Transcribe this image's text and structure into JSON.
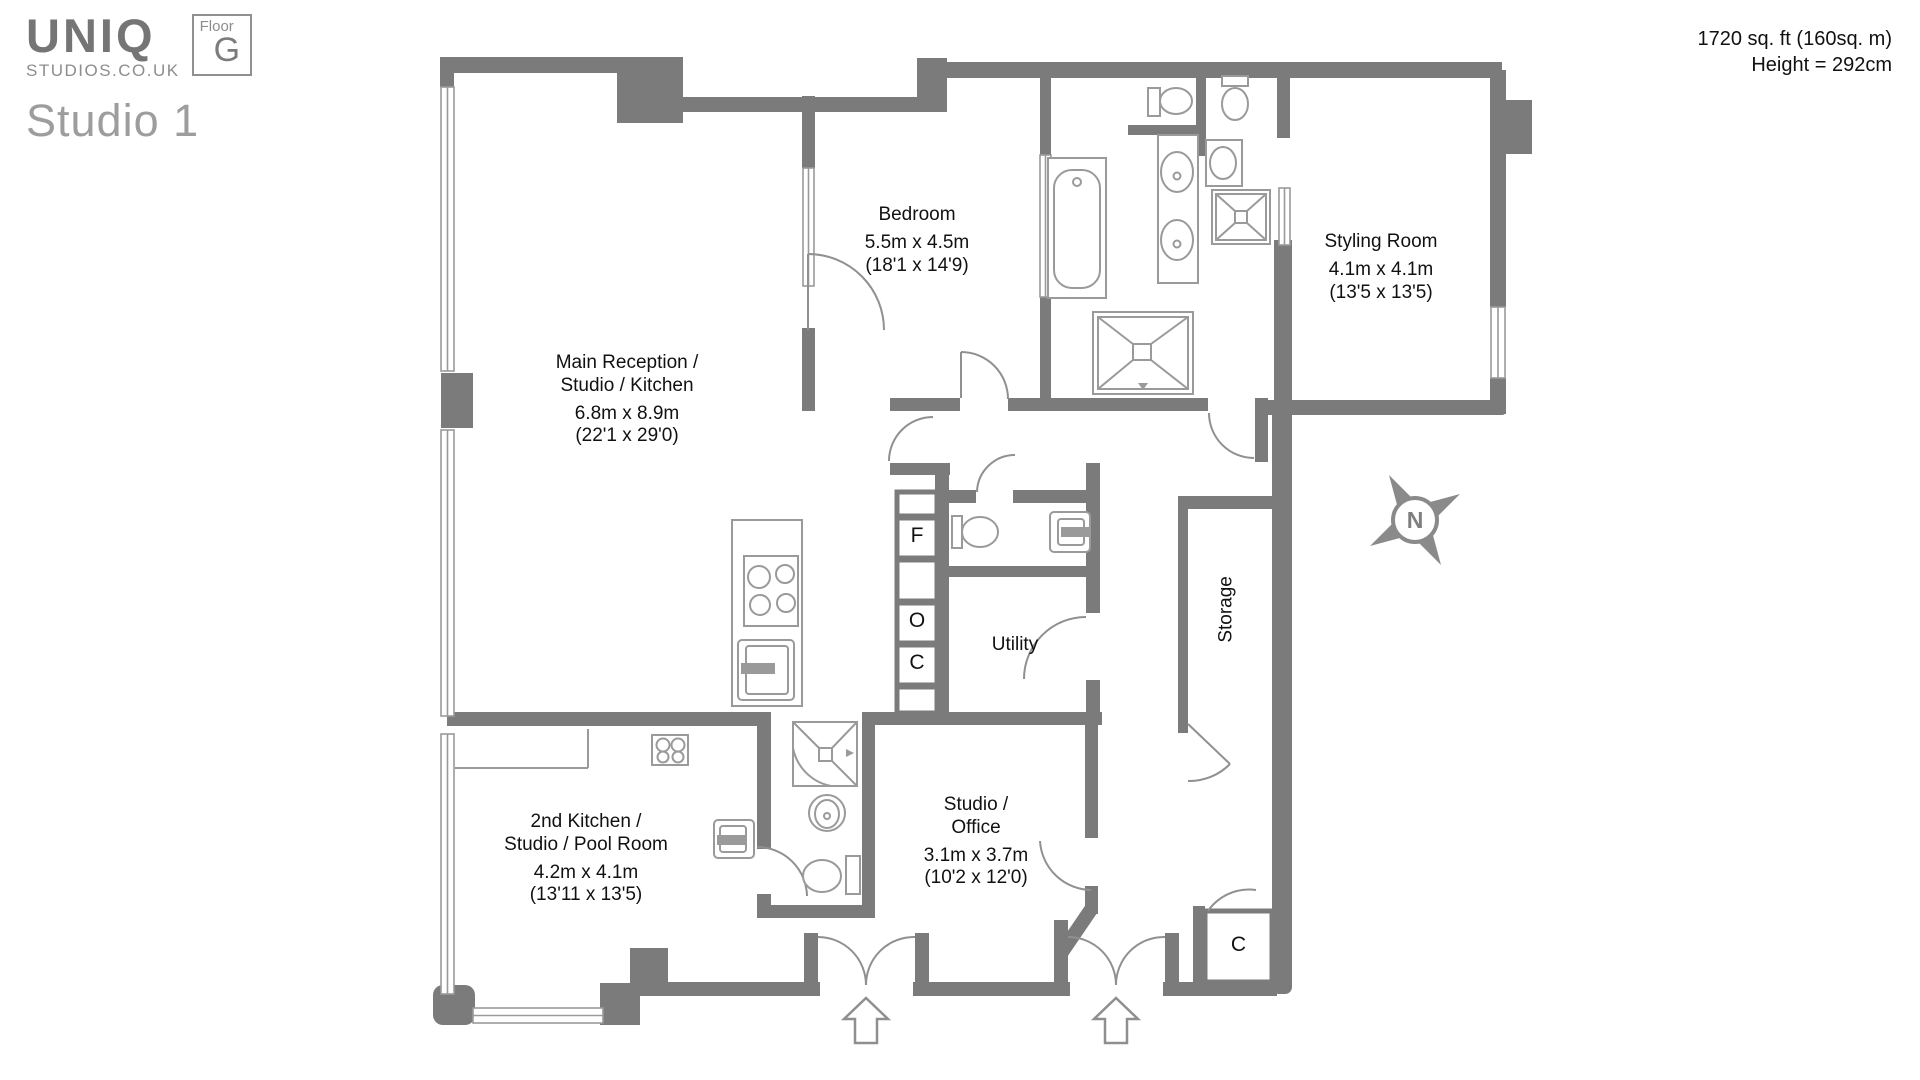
{
  "logo": {
    "brand": "UNIQ",
    "domain": "STUDIOS.CO.UK",
    "floor_label": "Floor",
    "floor_value": "G",
    "studio_title": "Studio 1"
  },
  "header": {
    "area": "1720 sq. ft (160sq. m)",
    "height": "Height = 292cm"
  },
  "rooms": {
    "main_reception": {
      "line1": "Main Reception /",
      "line2": "Studio / Kitchen",
      "metric": "6.8m x 8.9m",
      "imperial": "(22'1 x 29'0)"
    },
    "bedroom": {
      "line1": "Bedroom",
      "metric": "5.5m x 4.5m",
      "imperial": "(18'1 x 14'9)"
    },
    "styling_room": {
      "line1": "Styling Room",
      "metric": "4.1m x 4.1m",
      "imperial": "(13'5 x 13'5)"
    },
    "utility": {
      "line1": "Utility"
    },
    "storage": {
      "line1": "Storage"
    },
    "second_kitchen": {
      "line1": "2nd Kitchen /",
      "line2": "Studio / Pool Room",
      "metric": "4.2m x 4.1m",
      "imperial": "(13'11 x 13'5)"
    },
    "studio_office": {
      "line1": "Studio /",
      "line2": "Office",
      "metric": "3.1m x 3.7m",
      "imperial": "(10'2 x 12'0)"
    }
  },
  "markers": {
    "fridge": "F",
    "oven": "O",
    "cupboard": "C",
    "closet": "C",
    "compass_north": "N"
  },
  "colors": {
    "wall": "#7b7b7b",
    "fixture": "#979797",
    "text": "#111111"
  }
}
